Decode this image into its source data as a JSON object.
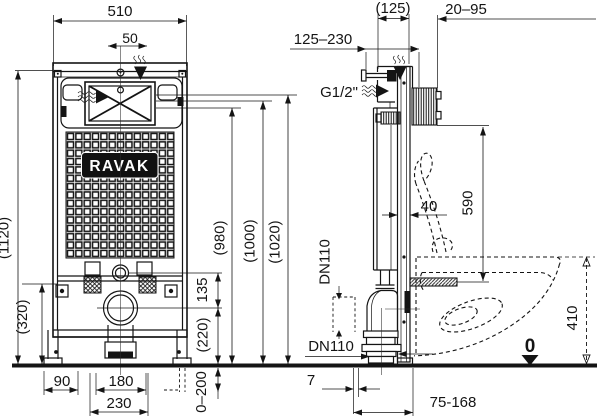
{
  "drawing_colors": {
    "line": "#141414",
    "background": "#ffffff",
    "logo_bg": "#111111",
    "logo_text": "#ffffff"
  },
  "brand": {
    "logo": "RAVAK"
  },
  "front_view": {
    "width": "510",
    "flush_plate_offset": "50",
    "total_height": "(1120)",
    "lower_height": "(320)",
    "h980": "(980)",
    "h1000": "(1000)",
    "h1020": "(1020)",
    "flush_to_outlet": "135",
    "outlet_height": "(220)",
    "leg_adjustment": "0–200",
    "foot_offset": "90",
    "stud_spacing": "180",
    "bracket_width": "230"
  },
  "side_view": {
    "frame_depth": "(125)",
    "wall_distance": "20–95",
    "support_range": "125–230",
    "water_connection": "G1/2\"",
    "profile_depth": "40",
    "connection_height": "590",
    "drain_upper": "DN110",
    "drain_lower": "DN110",
    "bowl_height": "410",
    "floor_level": "0",
    "outlet_offset": "7",
    "outlet_distance": "75-168"
  }
}
